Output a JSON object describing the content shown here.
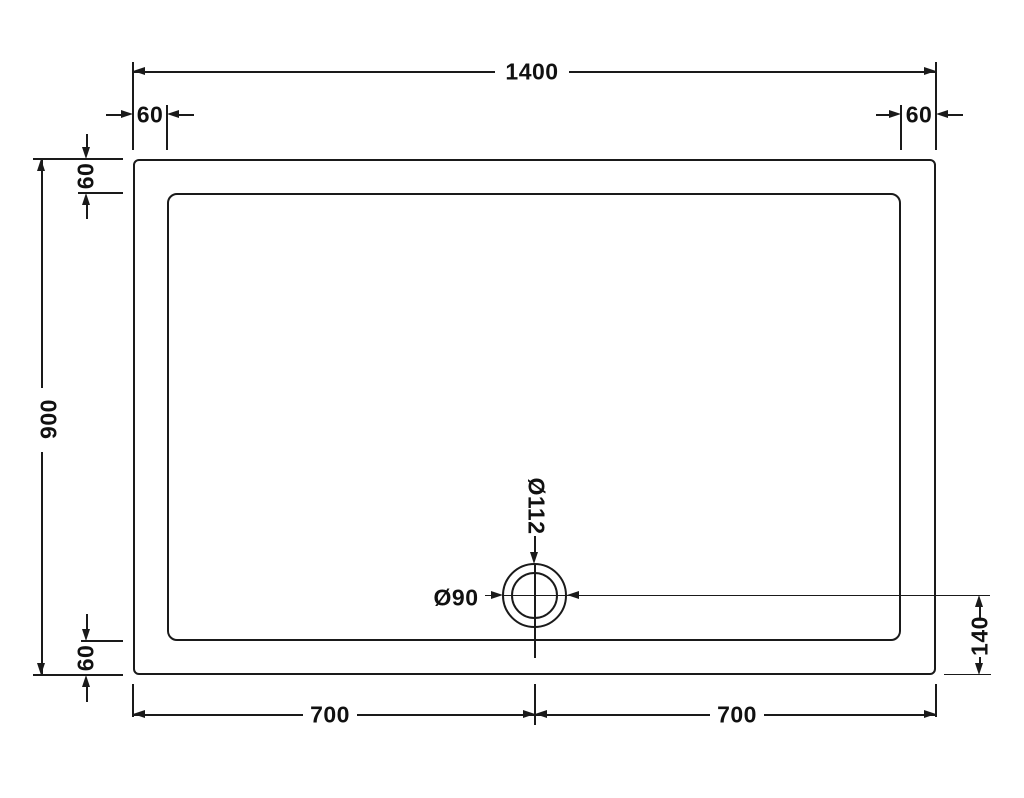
{
  "drawing": {
    "subject": "shower-tray-plan-technical-drawing",
    "colors": {
      "line": "#1a1a1a",
      "text": "#111111",
      "background": "#ffffff"
    },
    "labels": {
      "overall_width": "1400",
      "overall_height": "900",
      "rim_top_left": "60",
      "rim_top_right": "60",
      "rim_left_top": "60",
      "rim_bottom_left": "60",
      "waste_outer_diameter": "Ø112",
      "waste_inner_diameter": "Ø90",
      "waste_to_bottom_edge": "140",
      "bottom_span_left": "700",
      "bottom_span_right": "700"
    }
  }
}
